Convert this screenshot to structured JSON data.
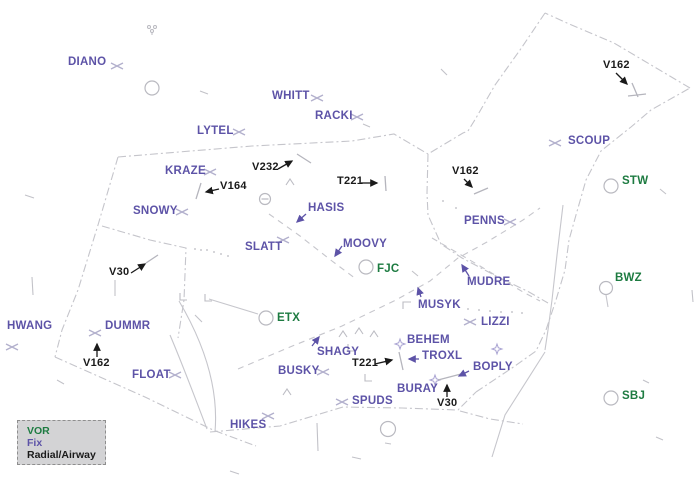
{
  "colors": {
    "vor": "#1d7b41",
    "fix": "#5d53a7",
    "radial": "#1a1a1a",
    "line": "#c6c6cc"
  },
  "legend": {
    "items": [
      {
        "label": "VOR",
        "type": "vor"
      },
      {
        "label": "Fix",
        "type": "fix"
      },
      {
        "label": "Radial/Airway",
        "type": "radial"
      }
    ]
  },
  "map": {
    "fixes": [
      {
        "name": "DIANO",
        "x": 68,
        "y": 57
      },
      {
        "name": "WHITT",
        "x": 272,
        "y": 91
      },
      {
        "name": "RACKI",
        "x": 315,
        "y": 111
      },
      {
        "name": "LYTEL",
        "x": 197,
        "y": 126
      },
      {
        "name": "KRAZE",
        "x": 165,
        "y": 166
      },
      {
        "name": "SNOWY",
        "x": 133,
        "y": 206
      },
      {
        "name": "HASIS",
        "x": 308,
        "y": 203
      },
      {
        "name": "SLATT",
        "x": 245,
        "y": 242
      },
      {
        "name": "MOOVY",
        "x": 343,
        "y": 239
      },
      {
        "name": "PENNS",
        "x": 464,
        "y": 216
      },
      {
        "name": "SCOUP",
        "x": 568,
        "y": 136
      },
      {
        "name": "MUDRE",
        "x": 467,
        "y": 277
      },
      {
        "name": "MUSYK",
        "x": 418,
        "y": 300
      },
      {
        "name": "LIZZI",
        "x": 481,
        "y": 317
      },
      {
        "name": "DUMMR",
        "x": 105,
        "y": 321
      },
      {
        "name": "HWANG",
        "x": 7,
        "y": 321
      },
      {
        "name": "FLOAT",
        "x": 132,
        "y": 370
      },
      {
        "name": "SHAGY",
        "x": 317,
        "y": 347
      },
      {
        "name": "BUSKY",
        "x": 278,
        "y": 366
      },
      {
        "name": "BEHEM",
        "x": 407,
        "y": 335
      },
      {
        "name": "TROXL",
        "x": 422,
        "y": 351
      },
      {
        "name": "BOPLY",
        "x": 473,
        "y": 362
      },
      {
        "name": "BURAY",
        "x": 397,
        "y": 384
      },
      {
        "name": "SPUDS",
        "x": 352,
        "y": 396
      },
      {
        "name": "HIKES",
        "x": 230,
        "y": 420
      }
    ],
    "vors": [
      {
        "name": "FJC",
        "x": 377,
        "y": 264
      },
      {
        "name": "ETX",
        "x": 277,
        "y": 313
      },
      {
        "name": "STW",
        "x": 622,
        "y": 176
      },
      {
        "name": "BWZ",
        "x": 615,
        "y": 273
      },
      {
        "name": "SBJ",
        "x": 622,
        "y": 391
      }
    ],
    "radials": [
      {
        "name": "V162",
        "x": 603,
        "y": 60
      },
      {
        "name": "V232",
        "x": 252,
        "y": 162
      },
      {
        "name": "V164",
        "x": 220,
        "y": 181
      },
      {
        "name": "T221",
        "x": 337,
        "y": 176
      },
      {
        "name": "V162",
        "x": 452,
        "y": 166
      },
      {
        "name": "V30",
        "x": 109,
        "y": 267
      },
      {
        "name": "V162",
        "x": 83,
        "y": 358
      },
      {
        "name": "T221",
        "x": 352,
        "y": 358
      },
      {
        "name": "V30",
        "x": 437,
        "y": 398
      }
    ]
  }
}
